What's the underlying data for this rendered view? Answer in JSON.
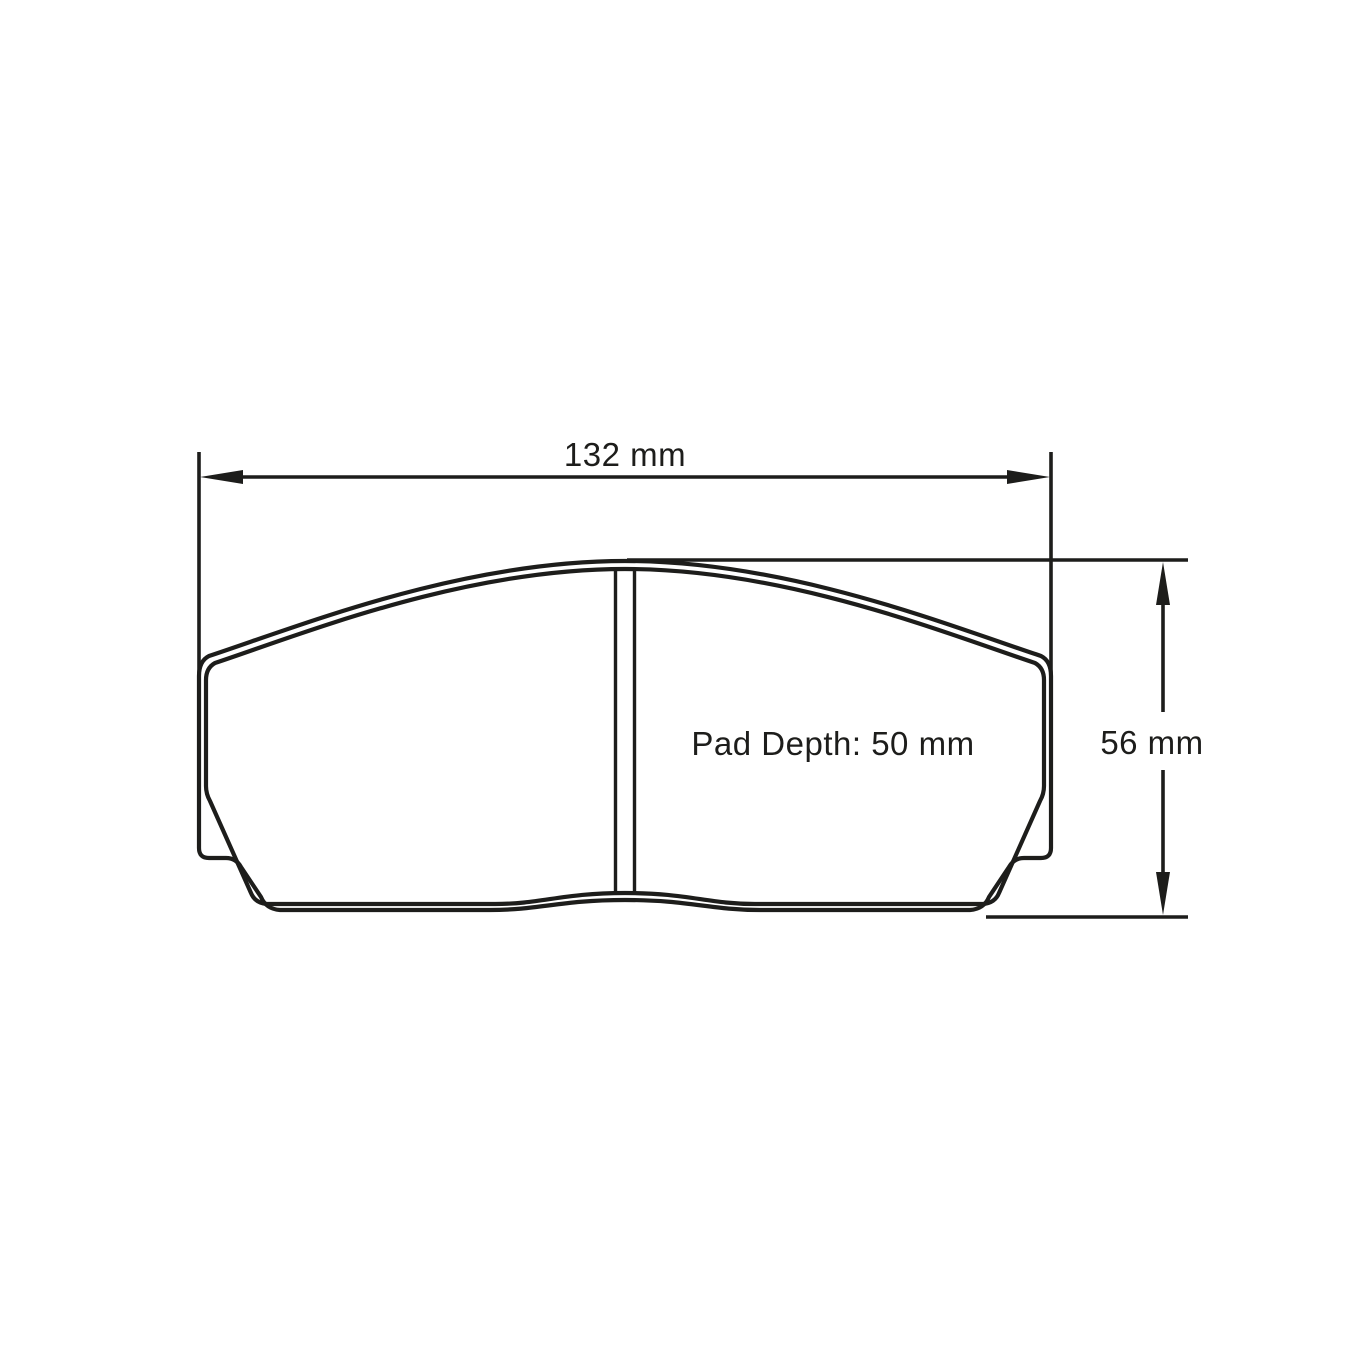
{
  "drawing": {
    "type": "technical-dimension-drawing",
    "subject": "brake-pad-profile",
    "colors": {
      "line": "#1d1d1b",
      "background": "#ffffff"
    },
    "dimensions": {
      "width": {
        "label": "132 mm",
        "value_mm": 132
      },
      "height": {
        "label": "56 mm",
        "value_mm": 56
      },
      "pad_depth": {
        "label": "Pad Depth: 50 mm",
        "value_mm": 50
      }
    }
  }
}
